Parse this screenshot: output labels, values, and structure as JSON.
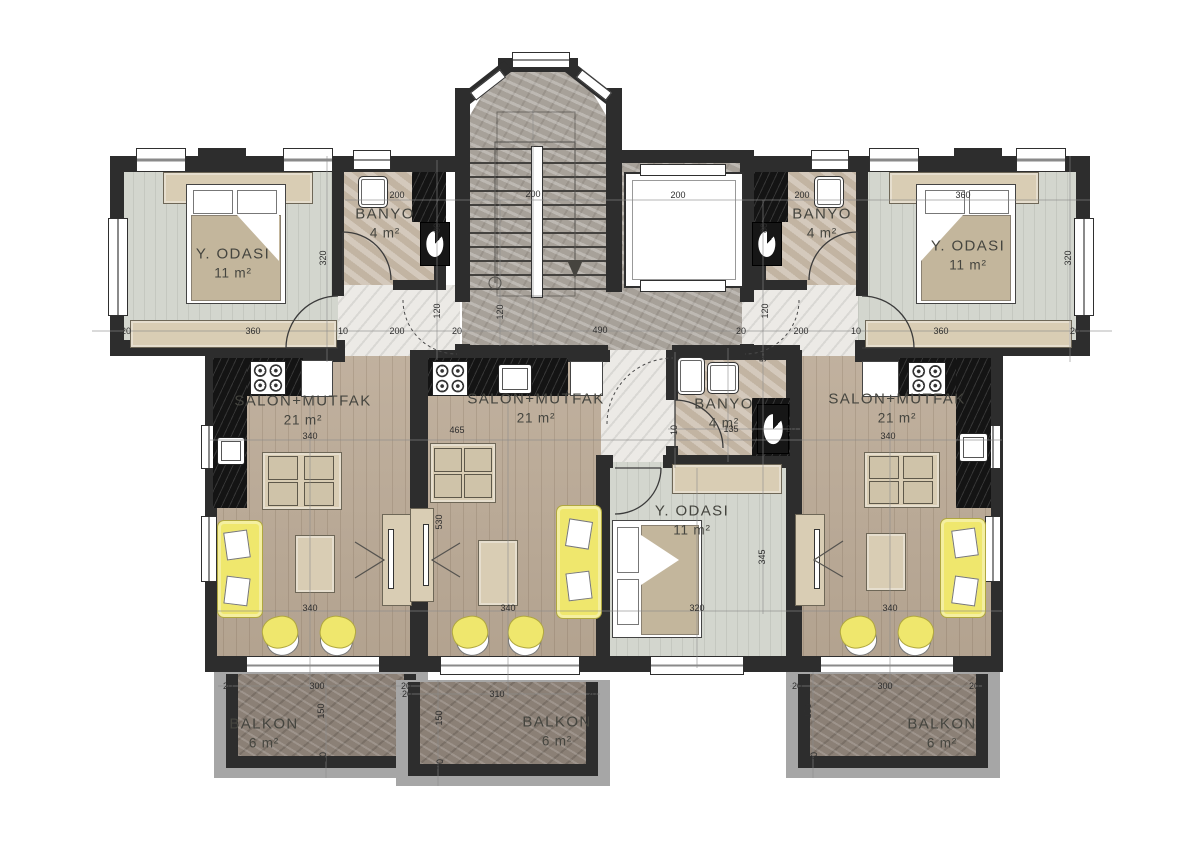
{
  "colors": {
    "wall": "#2d2d2d",
    "salon_floor": "#bcab97",
    "bedroom_floor": "#d3d6ce",
    "banyo_floor": "#c9bcab",
    "hall_floor": "#eceae6",
    "stair_floor": "#a7a199",
    "balcony_floor": "#8b8076",
    "accent_furniture": "#efe76d",
    "furniture_beige": "#d9cdb4",
    "label": "#45453f"
  },
  "rooms": [
    {
      "id": "bedroom-left",
      "label": "Y. ODASI",
      "area": "11 m²",
      "x": 233,
      "y": 263
    },
    {
      "id": "banyo-left",
      "label": "BANYO",
      "area": "4 m²",
      "x": 385,
      "y": 223
    },
    {
      "id": "bedroom-right",
      "label": "Y. ODASI",
      "area": "11 m²",
      "x": 968,
      "y": 255
    },
    {
      "id": "banyo-right",
      "label": "BANYO",
      "area": "4 m²",
      "x": 822,
      "y": 223
    },
    {
      "id": "salon-left",
      "label": "SALON+MUTFAK",
      "area": "21 m²",
      "x": 303,
      "y": 410
    },
    {
      "id": "salon-center",
      "label": "SALON+MUTFAK",
      "area": "21 m²",
      "x": 536,
      "y": 408
    },
    {
      "id": "salon-right",
      "label": "SALON+MUTFAK",
      "area": "21 m²",
      "x": 897,
      "y": 408
    },
    {
      "id": "bedroom-center",
      "label": "Y. ODASI",
      "area": "11 m²",
      "x": 692,
      "y": 520
    },
    {
      "id": "banyo-center",
      "label": "BANYO",
      "area": "4 m²",
      "x": 724,
      "y": 413
    },
    {
      "id": "balkon-left",
      "label": "BALKON",
      "area": "6 m²",
      "x": 264,
      "y": 733
    },
    {
      "id": "balkon-center",
      "label": "BALKON",
      "area": "6 m²",
      "x": 557,
      "y": 731
    },
    {
      "id": "balkon-right",
      "label": "BALKON",
      "area": "6 m²",
      "x": 942,
      "y": 733
    }
  ],
  "dims": [
    {
      "t": "200",
      "x": 397,
      "y": 195,
      "v": false
    },
    {
      "t": "80",
      "x": 437,
      "y": 228,
      "v": true
    },
    {
      "t": "320",
      "x": 323,
      "y": 258,
      "v": true
    },
    {
      "t": "200",
      "x": 533,
      "y": 194,
      "v": false
    },
    {
      "t": "200",
      "x": 678,
      "y": 195,
      "v": false
    },
    {
      "t": "200",
      "x": 802,
      "y": 195,
      "v": false
    },
    {
      "t": "360",
      "x": 963,
      "y": 195,
      "v": false
    },
    {
      "t": "80",
      "x": 764,
      "y": 228,
      "v": true
    },
    {
      "t": "320",
      "x": 1068,
      "y": 258,
      "v": true
    },
    {
      "t": "20",
      "x": 126,
      "y": 331,
      "v": false
    },
    {
      "t": "360",
      "x": 253,
      "y": 331,
      "v": false
    },
    {
      "t": "200",
      "x": 397,
      "y": 331,
      "v": false
    },
    {
      "t": "10",
      "x": 343,
      "y": 331,
      "v": false
    },
    {
      "t": "20",
      "x": 457,
      "y": 331,
      "v": false
    },
    {
      "t": "120",
      "x": 437,
      "y": 311,
      "v": true
    },
    {
      "t": "120",
      "x": 500,
      "y": 312,
      "v": true
    },
    {
      "t": "490",
      "x": 600,
      "y": 330,
      "v": false
    },
    {
      "t": "20",
      "x": 741,
      "y": 331,
      "v": false
    },
    {
      "t": "120",
      "x": 765,
      "y": 311,
      "v": true
    },
    {
      "t": "200",
      "x": 801,
      "y": 331,
      "v": false
    },
    {
      "t": "10",
      "x": 856,
      "y": 331,
      "v": false
    },
    {
      "t": "360",
      "x": 941,
      "y": 331,
      "v": false
    },
    {
      "t": "20",
      "x": 1075,
      "y": 331,
      "v": false
    },
    {
      "t": "50",
      "x": 763,
      "y": 357,
      "v": true
    },
    {
      "t": "340",
      "x": 310,
      "y": 436,
      "v": false
    },
    {
      "t": "465",
      "x": 457,
      "y": 430,
      "v": false
    },
    {
      "t": "530",
      "x": 439,
      "y": 522,
      "v": true
    },
    {
      "t": "340",
      "x": 888,
      "y": 436,
      "v": false
    },
    {
      "t": "10",
      "x": 674,
      "y": 430,
      "v": true
    },
    {
      "t": "135",
      "x": 731,
      "y": 429,
      "v": false
    },
    {
      "t": "20",
      "x": 791,
      "y": 429,
      "v": false
    },
    {
      "t": "345",
      "x": 762,
      "y": 557,
      "v": true
    },
    {
      "t": "340",
      "x": 310,
      "y": 608,
      "v": false
    },
    {
      "t": "340",
      "x": 508,
      "y": 608,
      "v": false
    },
    {
      "t": "320",
      "x": 697,
      "y": 608,
      "v": false
    },
    {
      "t": "340",
      "x": 890,
      "y": 608,
      "v": false
    },
    {
      "t": "20",
      "x": 228,
      "y": 686,
      "v": false
    },
    {
      "t": "300",
      "x": 317,
      "y": 686,
      "v": false
    },
    {
      "t": "20",
      "x": 406,
      "y": 686,
      "v": false
    },
    {
      "t": "150",
      "x": 321,
      "y": 711,
      "v": true
    },
    {
      "t": "20",
      "x": 323,
      "y": 757,
      "v": true
    },
    {
      "t": "20",
      "x": 407,
      "y": 694,
      "v": false
    },
    {
      "t": "310",
      "x": 497,
      "y": 694,
      "v": false
    },
    {
      "t": "20",
      "x": 592,
      "y": 694,
      "v": false
    },
    {
      "t": "150",
      "x": 439,
      "y": 718,
      "v": true
    },
    {
      "t": "20",
      "x": 440,
      "y": 764,
      "v": true
    },
    {
      "t": "20",
      "x": 797,
      "y": 686,
      "v": false
    },
    {
      "t": "300",
      "x": 885,
      "y": 686,
      "v": false
    },
    {
      "t": "20",
      "x": 974,
      "y": 686,
      "v": false
    },
    {
      "t": "150",
      "x": 808,
      "y": 711,
      "v": true
    },
    {
      "t": "20",
      "x": 814,
      "y": 757,
      "v": true
    }
  ]
}
